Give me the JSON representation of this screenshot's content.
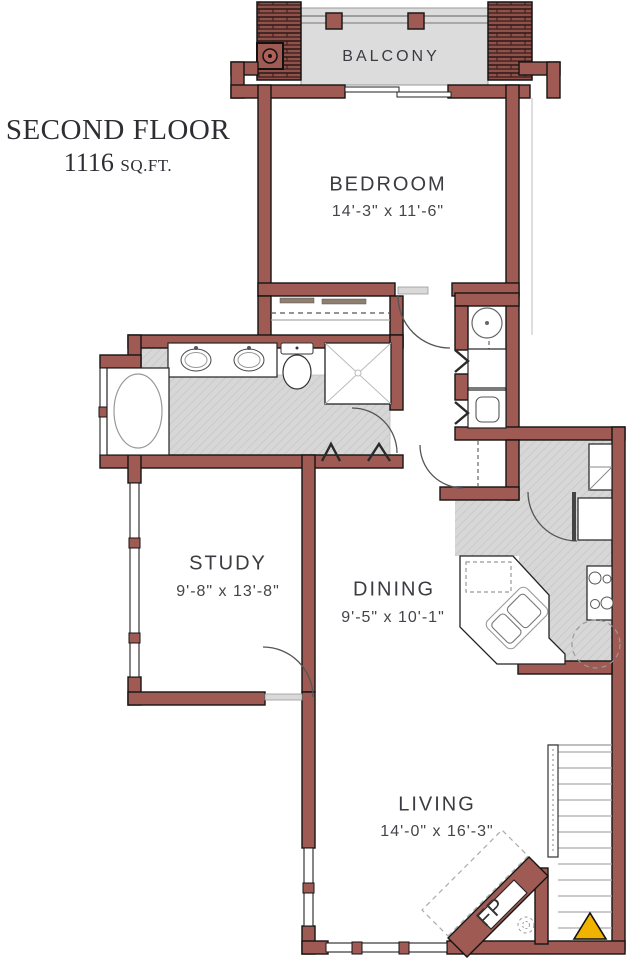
{
  "plan": {
    "title_line1": "SECOND FLOOR",
    "area_value": "1116",
    "area_unit": "SQ.FT.",
    "rooms": {
      "balcony": {
        "label": "BALCONY"
      },
      "bedroom": {
        "label": "BEDROOM",
        "dims": "14'-3\" x 11'-6\""
      },
      "study": {
        "label": "STUDY",
        "dims": "9'-8\" x 13'-8\""
      },
      "dining": {
        "label": "DINING",
        "dims": "9'-5\" x 10'-1\""
      },
      "living": {
        "label": "LIVING",
        "dims": "14'-0\" x 16'-3\""
      }
    },
    "fireplace_label": "FP",
    "colors": {
      "wall": "#9e5a53",
      "floor": "#d7d7d7",
      "triangle": "#f0b400"
    }
  }
}
